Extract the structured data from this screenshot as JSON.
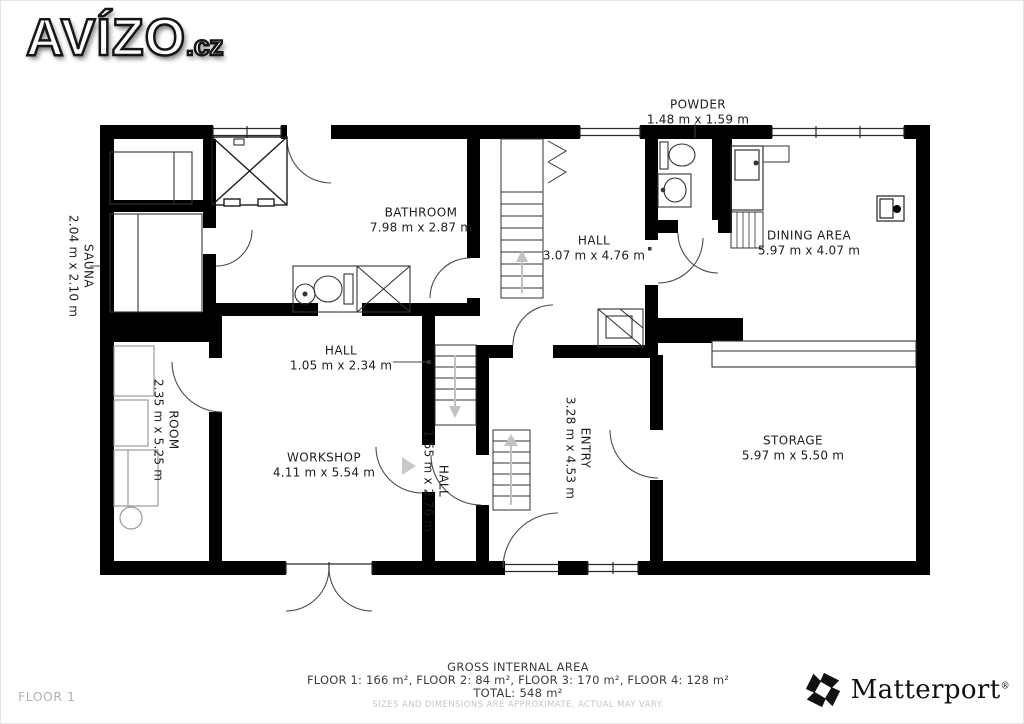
{
  "logo": {
    "text": "AVÍZO",
    "suffix": ".cz"
  },
  "rooms": [
    {
      "id": "powder",
      "name": "POWDER",
      "dims": "1.48 m x 1.59 m"
    },
    {
      "id": "sauna",
      "name": "SAUNA",
      "dims": "2.04 m x 2.10 m"
    },
    {
      "id": "bathroom",
      "name": "BATHROOM",
      "dims": "7.98 m x 2.87 m"
    },
    {
      "id": "hall-upper",
      "name": "HALL",
      "dims": "3.07 m x 4.76 m"
    },
    {
      "id": "dining-area",
      "name": "DINING AREA",
      "dims": "5.97 m x 4.07 m"
    },
    {
      "id": "room",
      "name": "ROOM",
      "dims": "2.35 m x 5.25 m"
    },
    {
      "id": "hall-middle",
      "name": "HALL",
      "dims": "1.05 m x 2.34 m"
    },
    {
      "id": "workshop",
      "name": "WORKSHOP",
      "dims": "4.11 m x 5.54 m"
    },
    {
      "id": "hall-lower",
      "name": "HALL",
      "dims": "1.55 m x 2.76 m"
    },
    {
      "id": "entry",
      "name": "ENTRY",
      "dims": "3.28 m x 4.53 m"
    },
    {
      "id": "storage",
      "name": "STORAGE",
      "dims": "5.97 m x 5.50 m"
    }
  ],
  "footer": {
    "floor_label": "FLOOR 1",
    "area_title": "GROSS INTERNAL AREA",
    "area_breakdown": "FLOOR 1: 166 m², FLOOR 2: 84 m², FLOOR 3: 170 m², FLOOR 4: 128 m²",
    "area_total": "TOTAL: 548 m²",
    "disclaimer": "SIZES AND DIMENSIONS ARE APPROXIMATE, ACTUAL MAY VARY.",
    "brand_name": "Matterport",
    "brand_mark": "®"
  },
  "colors": {
    "wall": "#000000",
    "fixture_line": "#333333",
    "furniture": "#9b9b9b",
    "arrow": "#c2c2c2",
    "disclaimer_text": "#c6c6c6"
  }
}
